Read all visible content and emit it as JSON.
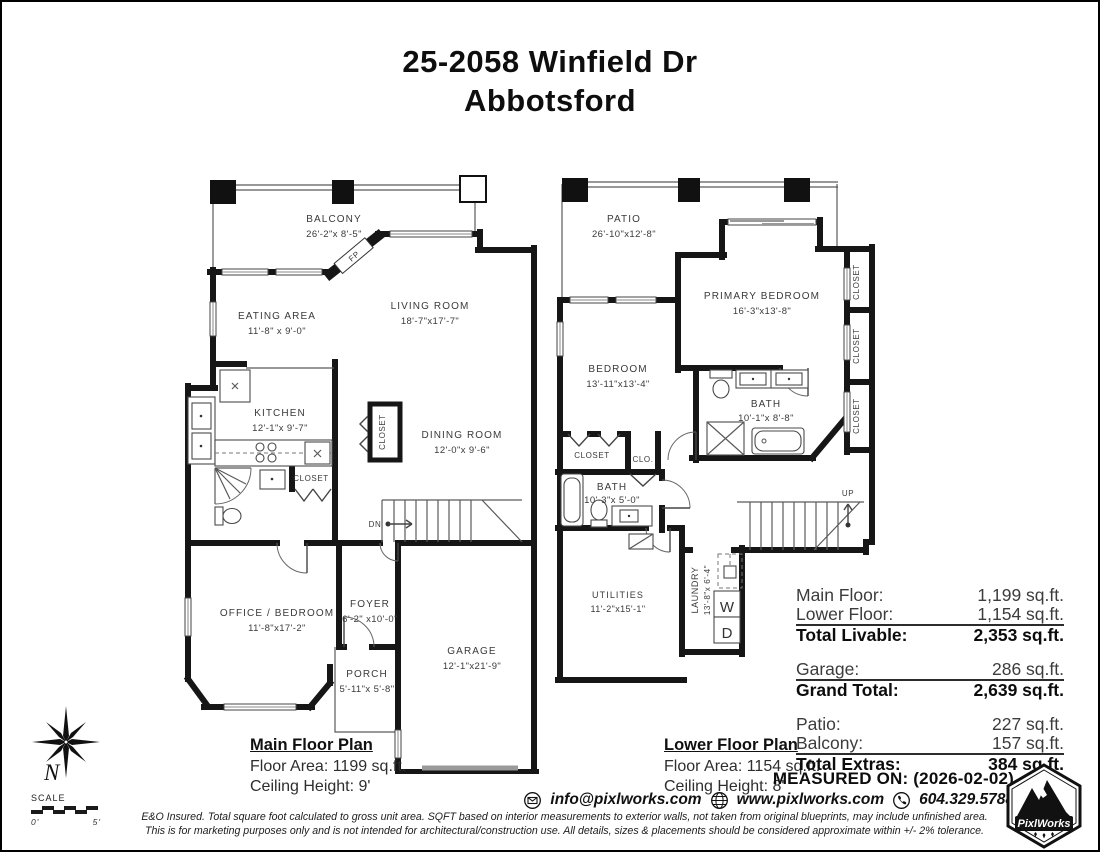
{
  "page": {
    "title_line1": "25-2058 Winfield Dr",
    "title_line2": "Abbotsford"
  },
  "colors": {
    "ink": "#161616",
    "label": "#3a3a3a"
  },
  "main_floor": {
    "caption": {
      "title": "Main Floor Plan",
      "area": "Floor Area: 1199 sq.ft.",
      "ceiling": "Ceiling Height: 9'"
    },
    "rooms": {
      "balcony": {
        "name": "BALCONY",
        "dims": "26'-2\"x 8'-5\""
      },
      "eating_area": {
        "name": "EATING AREA",
        "dims": "11'-8\" x 9'-0\""
      },
      "living_room": {
        "name": "LIVING ROOM",
        "dims": "18'-7\"x17'-7\""
      },
      "kitchen": {
        "name": "KITCHEN",
        "dims": "12'-1\"x 9'-7\""
      },
      "dining_room": {
        "name": "DINING ROOM",
        "dims": "12'-0\"x 9'-6\""
      },
      "office_bedroom": {
        "name": "OFFICE / BEDROOM",
        "dims": "11'-8\"x17'-2\""
      },
      "foyer": {
        "name": "FOYER",
        "dims": "6'-2\" x10'-0\""
      },
      "porch": {
        "name": "PORCH",
        "dims": "5'-11\"x 5'-8\""
      },
      "garage": {
        "name": "GARAGE",
        "dims": "12'-1\"x21'-9\""
      },
      "closet_dining": "CLOSET",
      "closet_bath": "CLOSET",
      "fireplace": "FP",
      "stairs_dn": "DN"
    }
  },
  "lower_floor": {
    "caption": {
      "title": "Lower Floor Plan",
      "area": "Floor Area: 1154 sq.ft.",
      "ceiling": "Ceiling Height: 8'"
    },
    "rooms": {
      "patio": {
        "name": "PATIO",
        "dims": "26'-10\"x12'-8\""
      },
      "primary_bedroom": {
        "name": "PRIMARY BEDROOM",
        "dims": "16'-3\"x13'-8\""
      },
      "bedroom": {
        "name": "BEDROOM",
        "dims": "13'-11\"x13'-4\""
      },
      "bath_upper": {
        "name": "BATH",
        "dims": "10'-1\"x 8'-8\""
      },
      "bath_lower": {
        "name": "BATH",
        "dims": "10'-3\"x 5'-0\""
      },
      "utilities": {
        "name": "UTILITIES",
        "dims": "11'-2\"x15'-1\""
      },
      "laundry": {
        "name": "LAUNDRY",
        "dims": "13'-8\"x 6'-4\""
      },
      "closet1": "CLOSET",
      "closet2": "CLOSET",
      "closet3": "CLOSET",
      "closet_h": "CLOSET",
      "clo": "CLO.",
      "stairs_up": "UP",
      "washer": "W",
      "dryer": "D"
    }
  },
  "summary": {
    "groups": [
      {
        "rows": [
          {
            "label": "Main Floor:",
            "value": "1,199 sq.ft."
          },
          {
            "label": "Lower Floor:",
            "value": "1,154 sq.ft."
          }
        ],
        "total": {
          "label": "Total Livable:",
          "value": "2,353 sq.ft."
        }
      },
      {
        "rows": [
          {
            "label": "Garage:",
            "value": "286 sq.ft."
          }
        ],
        "total": {
          "label": "Grand Total:",
          "value": "2,639 sq.ft."
        }
      },
      {
        "rows": [
          {
            "label": "Patio:",
            "value": "227 sq.ft."
          },
          {
            "label": "Balcony:",
            "value": "157 sq.ft."
          }
        ],
        "total": {
          "label": "Total Extras:",
          "value": "384 sq.ft."
        }
      }
    ]
  },
  "footer": {
    "measured_on": "MEASURED ON: (2026-02-02)",
    "email": "info@pixlworks.com",
    "website": "www.pixlworks.com",
    "phone": "604.329.5788",
    "disclaimer_line1": "E&O Insured.  Total square foot calculated to gross unit area. SQFT based on interior measurements to exterior walls, not taken from original blueprints, may include unfinished area.",
    "disclaimer_line2": "This is for marketing purposes only and is not intended for architectural/construction use.  All details, sizes & placements should be considered approximate within +/- 2%  tolerance.",
    "scale_label": "SCALE",
    "scale_start": "0'",
    "scale_end": "5'",
    "compass_label": "N",
    "logo_text": "PixlWorks"
  }
}
